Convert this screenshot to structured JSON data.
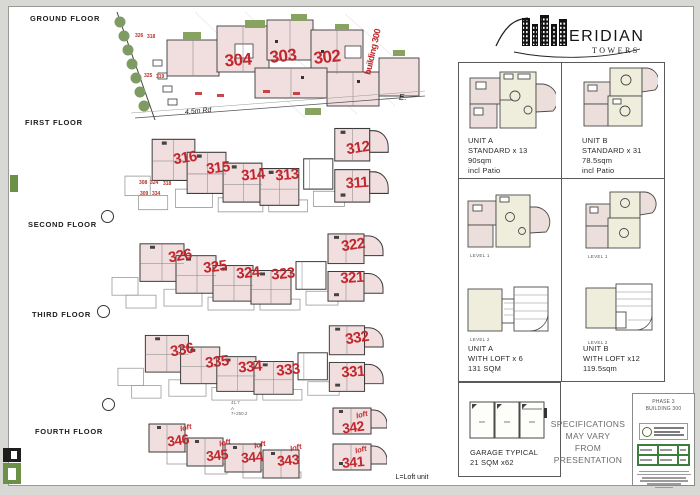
{
  "colors": {
    "accent_red": "#c1272d",
    "plan_pink": "#f1dede",
    "landscape_green": "#7d9b62",
    "interior_cream": "#efeedd",
    "titleblock_green": "#3f7d3f"
  },
  "brand": {
    "suffix": "ERIDIAN",
    "subtitle": "TOWERS"
  },
  "floor_labels": {
    "ground": "GROUND FLOOR",
    "first": "FIRST FLOOR",
    "second": "SECOND FLOOR",
    "third": "THIRD FLOOR",
    "fourth": "FOURTH FLOOR"
  },
  "ground": {
    "numbers": [
      "304",
      "303",
      "302"
    ],
    "small_numbers": [
      "326",
      "318",
      "325",
      "319"
    ],
    "building_label": "building 300",
    "road_label": "4.5m Rd",
    "east_label": "E."
  },
  "first": {
    "numbers": [
      "316",
      "315",
      "314",
      "313",
      "312",
      "311"
    ],
    "small_numbers": [
      "308",
      "324",
      "318",
      "309",
      "334"
    ]
  },
  "second": {
    "numbers": [
      "326",
      "325",
      "324",
      "323",
      "322",
      "321"
    ]
  },
  "third": {
    "numbers": [
      "336",
      "335",
      "334",
      "333",
      "332",
      "331"
    ]
  },
  "fourth": {
    "numbers": [
      "346",
      "345",
      "344",
      "343",
      "342",
      "341"
    ],
    "loft_label": "loft",
    "dim_note": "41.7\nA\n7+250.2"
  },
  "panels": {
    "unit_a_std": {
      "l1": "UNIT A",
      "l2": "STANDARD x 13",
      "l3": "90sqm",
      "l4": "incl Patio"
    },
    "unit_b_std": {
      "l1": "UNIT B",
      "l2": "STANDARD x 31",
      "l3": "78.5sqm",
      "l4": "incl Patio"
    },
    "unit_a_loft": {
      "l1": "UNIT A",
      "l2": "WITH LOFT x 6",
      "l3": "131 SQM",
      "level1": "LEVEL 1",
      "level2": "LEVEL 2"
    },
    "unit_b_loft": {
      "l1": "UNIT B",
      "l2": "WITH LOFT x12",
      "l3": "119.5sqm",
      "level1": "LEVEL 1",
      "level2": "LEVEL 2"
    },
    "garage": {
      "l1": "GARAGE TYPICAL",
      "l2": "21 SQM x62"
    }
  },
  "disclaimer": {
    "l1": "SPECIFICATIONS",
    "l2": "MAY VARY",
    "l3": "FROM",
    "l4": "PRESENTATION"
  },
  "titleblock": {
    "phase": "PHASE 3",
    "building": "BUILDING 300"
  },
  "footer": {
    "legend": "L=Loft unit"
  }
}
